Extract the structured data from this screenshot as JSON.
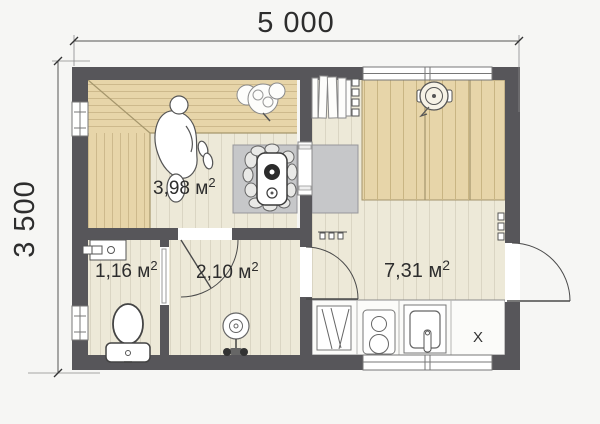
{
  "colors": {
    "page": "#f6f6f4",
    "wall": "#57565a",
    "bench": "#e7d5a9",
    "floor": "#ede9d8",
    "platform": "#c6c7c9",
    "counter": "#fbfbf9"
  },
  "dimensions": {
    "width_label": "5 000",
    "height_label": "3 500"
  },
  "rooms": [
    {
      "name": "steam-room",
      "area_label": "3,98 м",
      "area_sup": "2"
    },
    {
      "name": "wc",
      "area_label": "1,16 м",
      "area_sup": "2"
    },
    {
      "name": "shower",
      "area_label": "2,10 м",
      "area_sup": "2"
    },
    {
      "name": "lounge",
      "area_label": "7,31 м",
      "area_sup": "2"
    }
  ],
  "kitchen": {
    "cabinet_label": "X"
  },
  "symbols": [
    "toilet",
    "wash-basin",
    "shower-drain",
    "shower-mixer",
    "wood-stove",
    "firewood-stack",
    "coat-hooks",
    "dining-table",
    "stool",
    "person",
    "plant",
    "window",
    "door-swing",
    "cooktop",
    "kitchen-sink",
    "drying-rack"
  ]
}
